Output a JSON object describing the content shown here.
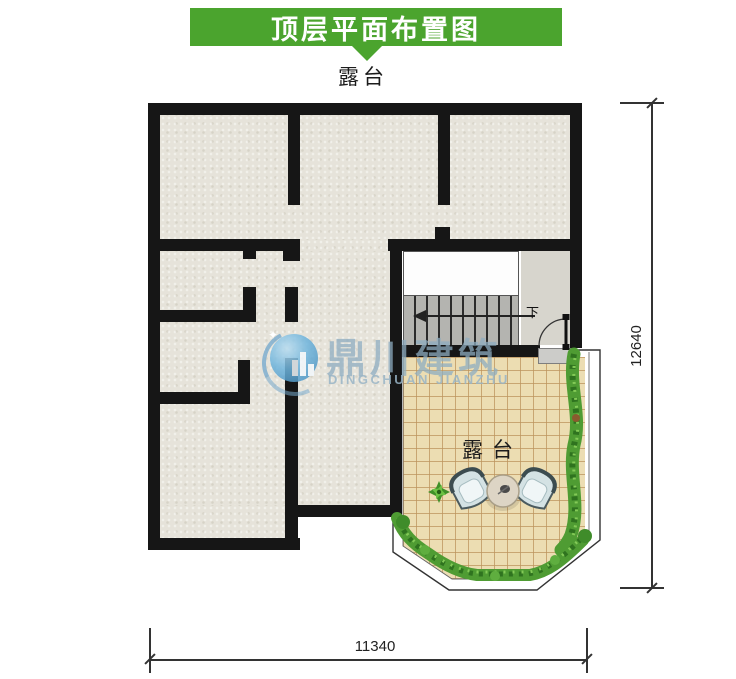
{
  "banner": {
    "title": "顶层平面布置图"
  },
  "plan": {
    "top_label": "露台",
    "terrace_label": "露台",
    "stairs_label": "下"
  },
  "dimensions": {
    "right": "12640",
    "bottom": "11340"
  },
  "watermark": {
    "cn": "鼎川建筑",
    "en": "DINGCHUAN JIANZHU",
    "star": "✦"
  },
  "colors": {
    "banner_green": "#4ba42e",
    "wall_black": "#161616",
    "floor_beige": "#e6e3da",
    "tile_beige": "#ecddb2",
    "tile_line": "#bc945c",
    "stair_gray": "#b4b4b0",
    "landing_gray": "#d7d5cd",
    "plant_green": "#4f9c33",
    "watermark_blue": "#8eacc2"
  }
}
